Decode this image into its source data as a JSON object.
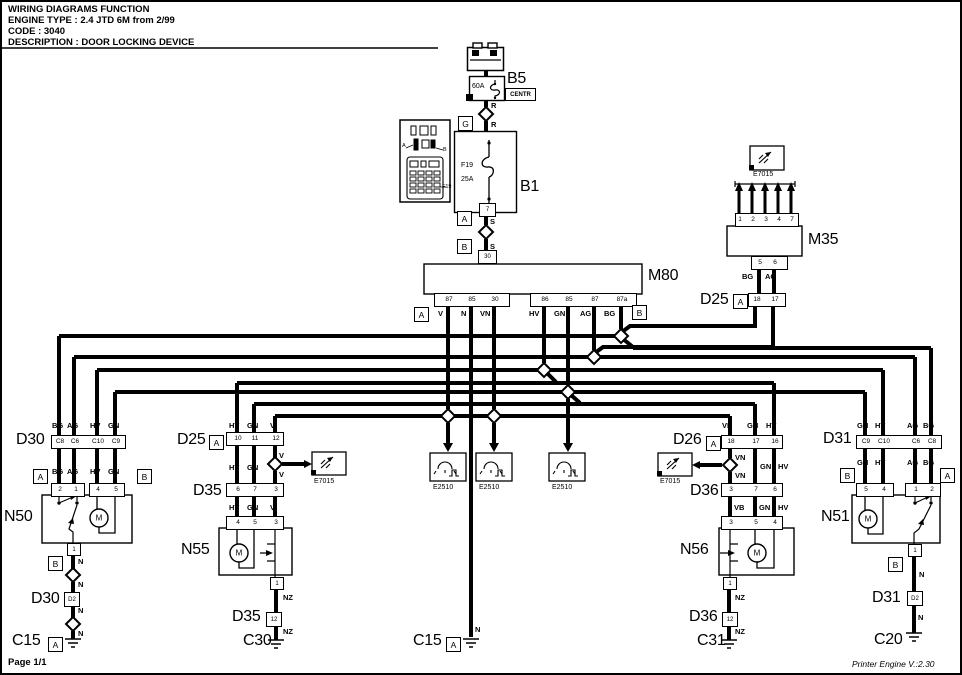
{
  "header": {
    "line1": "WIRING DIAGRAMS FUNCTION",
    "line2": "ENGINE TYPE : 2.4 JTD 6M from 2/99",
    "line3": "CODE : 3040",
    "line4": "DESCRIPTION : DOOR LOCKING DEVICE"
  },
  "battery": {
    "label": "B5",
    "rating": "60A",
    "sub": "CENTR"
  },
  "fusebox": {
    "label": "B1",
    "fuse": "F19",
    "rating": "25A"
  },
  "inset": {
    "a": "A",
    "b": "B",
    "f": "F19"
  },
  "m80": {
    "label": "M80",
    "pins_left": [
      "87",
      "85",
      "30"
    ],
    "pins_right": [
      "86",
      "85",
      "87",
      "87a"
    ]
  },
  "m35": {
    "label": "M35",
    "pins_top": [
      "1",
      "2",
      "3",
      "4",
      "7"
    ],
    "pins_bottom": [
      "5",
      "6"
    ]
  },
  "refs": {
    "e7015": "E7015",
    "e2510": "E2510",
    "motor": "M"
  },
  "letters": {
    "a": "A",
    "b": "B",
    "g": "G",
    "d2": "D2",
    "twelve": "12",
    "one": "1",
    "seven": "7",
    "thirty": "30"
  },
  "wires": {
    "bg": "BG",
    "ag": "AG",
    "hv": "HV",
    "gn": "GN",
    "v": "V",
    "n": "N",
    "vn": "VN",
    "nz": "NZ",
    "vb": "VB",
    "r": "R",
    "s": "S"
  },
  "d25_top": {
    "label": "D25",
    "pins": [
      "18",
      "17"
    ]
  },
  "d30": {
    "label": "D30",
    "pins": [
      "C8",
      "C6",
      "C10",
      "C9"
    ]
  },
  "d25": {
    "label": "D25",
    "pins": [
      "10",
      "11",
      "12"
    ]
  },
  "d26": {
    "label": "D26",
    "pins": [
      "18",
      "17",
      "16"
    ]
  },
  "d31": {
    "label": "D31",
    "pins": [
      "C9",
      "C10",
      "C6",
      "C8"
    ]
  },
  "d35": {
    "label": "D35",
    "pins": [
      "6",
      "7",
      "3"
    ]
  },
  "d36": {
    "label": "D36",
    "pins": [
      "3",
      "7",
      "6"
    ]
  },
  "n50": {
    "label": "N50",
    "pins": [
      "2",
      "1",
      "4",
      "5"
    ]
  },
  "n55": {
    "label": "N55",
    "pins": [
      "4",
      "5",
      "3"
    ]
  },
  "n56": {
    "label": "N56",
    "pins": [
      "3",
      "5",
      "4"
    ]
  },
  "n51": {
    "label": "N51",
    "pins": [
      "5",
      "4",
      "1",
      "2"
    ]
  },
  "grounds": {
    "c15": "C15",
    "c30": "C30",
    "c31": "C31",
    "c20": "C20"
  },
  "footer": {
    "page": "Page 1/1",
    "printer": "Printer Engine V.:2.30"
  }
}
